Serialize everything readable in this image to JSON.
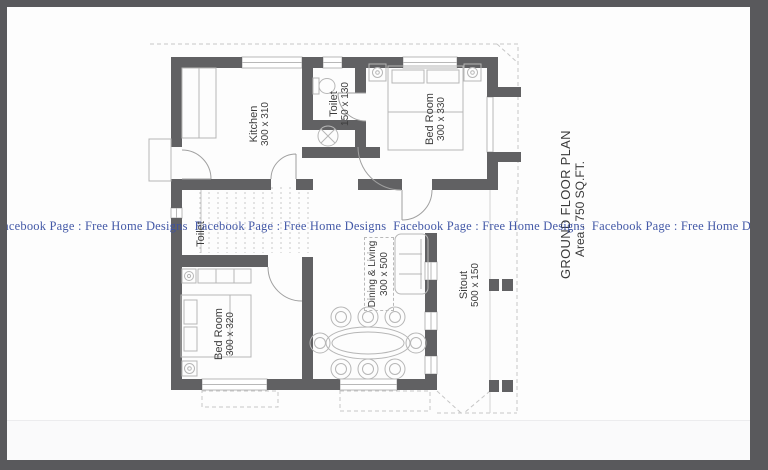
{
  "watermark": {
    "text": "Facebook Page : Free Home Designs",
    "color": "#3b51a3"
  },
  "plan": {
    "title": "GROUND FLOOR PLAN",
    "subtitle": "Area : 750 SQ.FT.",
    "wall_color": "#616163",
    "rooms": [
      {
        "name": "Kitchen",
        "dims": "300 x 310"
      },
      {
        "name": "Toilet",
        "dims": "150 x 130"
      },
      {
        "name": "Bed Room",
        "dims": "300 x 330"
      },
      {
        "name": "Toilet",
        "dims": ""
      },
      {
        "name": "Bed Room",
        "dims": "300 x 320"
      },
      {
        "name": "Dining & Living",
        "dims": "300 x 500"
      },
      {
        "name": "Sitout",
        "dims": "500 x 150"
      }
    ]
  }
}
